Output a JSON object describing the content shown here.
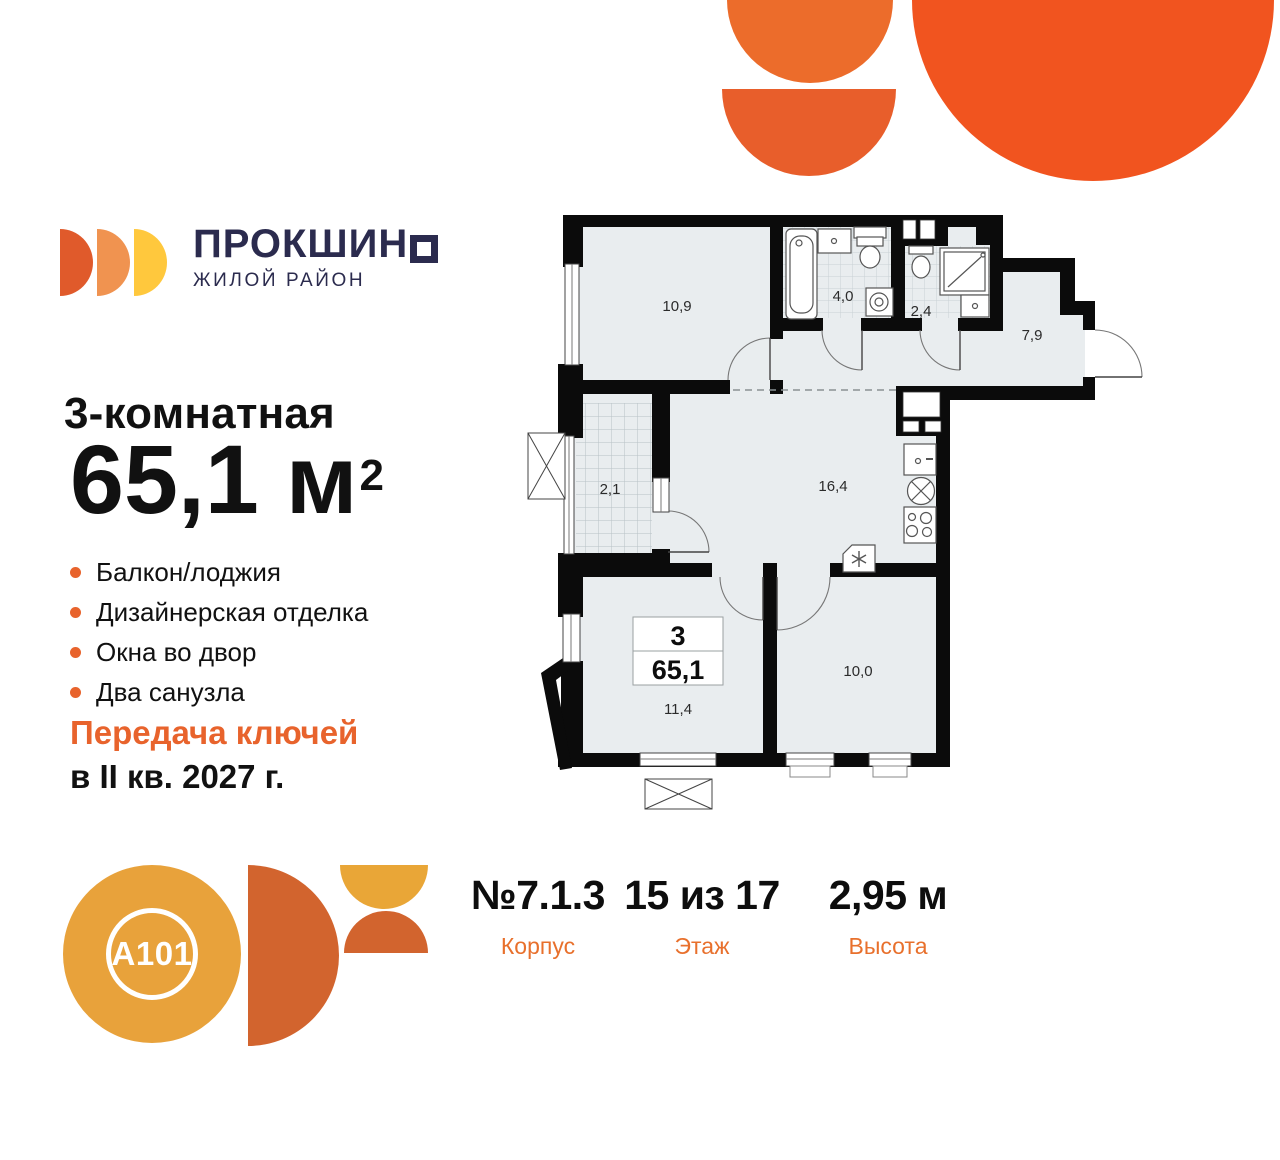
{
  "brand": {
    "wordmark": "ПРОКШИНО",
    "wordmark_text": "ПРОКШИН",
    "wordmark_square_letter": "О",
    "tagline": "ЖИЛОЙ РАЙОН"
  },
  "listing": {
    "rooms_title": "3-комнатная",
    "area_value": "65,1 м",
    "area_sup": "2",
    "features": [
      "Балкон/лоджия",
      "Дизайнерская отделка",
      "Окна во двор",
      "Два санузла"
    ],
    "handover_line1": "Передача ключей",
    "handover_line2": "в II кв. 2027 г."
  },
  "plan": {
    "areas": {
      "bedroom": "10,9",
      "bathroom_big": "4,0",
      "bathroom_small": "2,4",
      "hallway": "7,9",
      "balcony": "2,1",
      "kitchen_living": "16,4",
      "room_left": "11,4",
      "room_right": "10,0"
    },
    "info_box": {
      "rooms_count": "3",
      "total_area": "65,1"
    }
  },
  "stats": {
    "items": [
      {
        "value": "№7.1.3",
        "label": "Корпус"
      },
      {
        "value": "15 из 17",
        "label": "Этаж"
      },
      {
        "value": "2,95 м",
        "label": "Высота"
      }
    ]
  },
  "developer": {
    "logo_text": "A101"
  },
  "colors": {
    "accent_orange": "#E8632C",
    "navy": "#2B2B4E",
    "wall_black": "#0B0B0B",
    "room_fill": "#E9EDEF",
    "decor_orange": "#F1541F"
  }
}
